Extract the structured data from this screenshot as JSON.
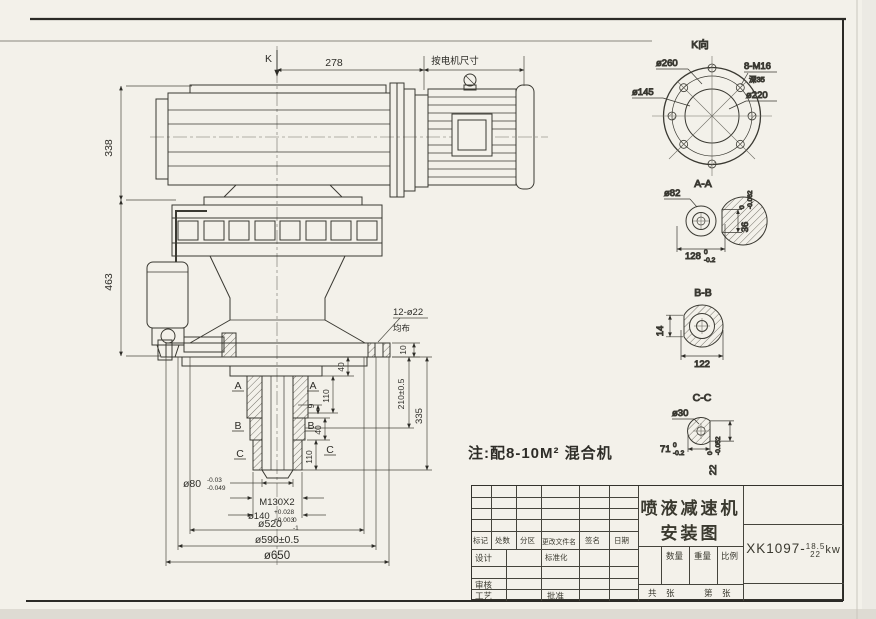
{
  "main_view": {
    "k_label": "K",
    "dim_278": "278",
    "dim_motor": "按电机尺寸",
    "dim_338": "338",
    "dim_463": "463",
    "holes": "12-ø22",
    "holes_note": "均布",
    "dim_10": "10",
    "dim_40_top": "40",
    "dim_110_top": "110",
    "dim_9": "9",
    "dim_40_mid": "40",
    "dim_110_bot": "110",
    "dim_210": "210±0.5",
    "dim_335": "335",
    "sec_a": "A",
    "sec_b": "B",
    "sec_c": "C",
    "d80": "ø80",
    "d80_up": "-0.03",
    "d80_lo": "-0.049",
    "m130": "M130X2",
    "d140": "ø140",
    "d140_up": "+0.028",
    "d140_lo": "+0.003",
    "d520": "ø520",
    "d520_up": "0",
    "d520_lo": "-1",
    "d590": "ø590±0.5",
    "d650": "ø650",
    "note": "注:配8-10M² 混合机"
  },
  "view_k": {
    "title": "K向",
    "d260": "ø260",
    "d145": "ø145",
    "bolts": "8-M16",
    "depth": "深35",
    "d220": "ø220"
  },
  "view_aa": {
    "title": "A-A",
    "d82": "ø82",
    "w": "128",
    "w_up": "0",
    "w_lo": "-0.2",
    "h": "36",
    "h_up": "0",
    "h_lo": "-0.062"
  },
  "view_bb": {
    "title": "B-B",
    "key": "14",
    "w": "122"
  },
  "view_cc": {
    "title": "C-C",
    "d30": "ø30",
    "w": "71",
    "w_up": "0",
    "w_lo": "-0.2",
    "h": "22",
    "h_up": "0",
    "h_lo": "-0.052"
  },
  "title_block": {
    "header_cells": [
      "标记",
      "处数",
      "分区",
      "更改文件名",
      "签名",
      "日期"
    ],
    "design_label": "设计",
    "standardize_label": "标准化",
    "audit_label": "审核",
    "process_label": "工艺",
    "approve_label": "批准",
    "product_title_line1": "喷液减速机",
    "product_title_line2": "安装图",
    "qty_label": "数量",
    "weight_label": "重量",
    "scale_label": "比例",
    "total_label": "共",
    "sheet_label": "张",
    "page_label": "第",
    "sheet_label2": "张",
    "drawing_no_prefix": "XK1097-",
    "power_top": "18.5",
    "power_bottom": "22",
    "power_unit": "kw"
  }
}
